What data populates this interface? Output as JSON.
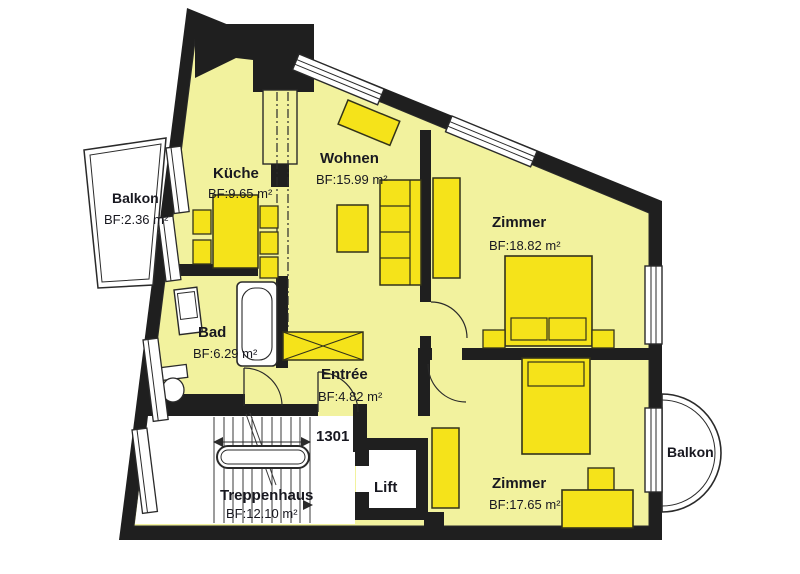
{
  "unit": {
    "number": "1301"
  },
  "rooms": [
    {
      "id": "kueche",
      "name": "Küche",
      "area": "BF:9.65 m²"
    },
    {
      "id": "wohnen",
      "name": "Wohnen",
      "area": "BF:15.99 m²"
    },
    {
      "id": "zimmer-nord",
      "name": "Zimmer",
      "area": "BF:18.82 m²"
    },
    {
      "id": "bad",
      "name": "Bad",
      "area": "BF:6.29 m²"
    },
    {
      "id": "entree",
      "name": "Entrée",
      "area": "BF:4.82 m²"
    },
    {
      "id": "zimmer-sued",
      "name": "Zimmer",
      "area": "BF:17.65 m²"
    },
    {
      "id": "treppenhaus",
      "name": "Treppenhaus",
      "area": "BF:12.10 m²"
    },
    {
      "id": "balkon-west",
      "name": "Balkon",
      "area": "BF:2.36 m²"
    },
    {
      "id": "balkon-ost",
      "name": "Balkon",
      "area": ""
    },
    {
      "id": "lift",
      "name": "Lift",
      "area": ""
    }
  ],
  "colors": {
    "room_fill": "#f2f29e",
    "furniture_fill": "#f5e31a",
    "wall": "#1f1f1f",
    "text": "#181820",
    "background": "#ffffff"
  }
}
